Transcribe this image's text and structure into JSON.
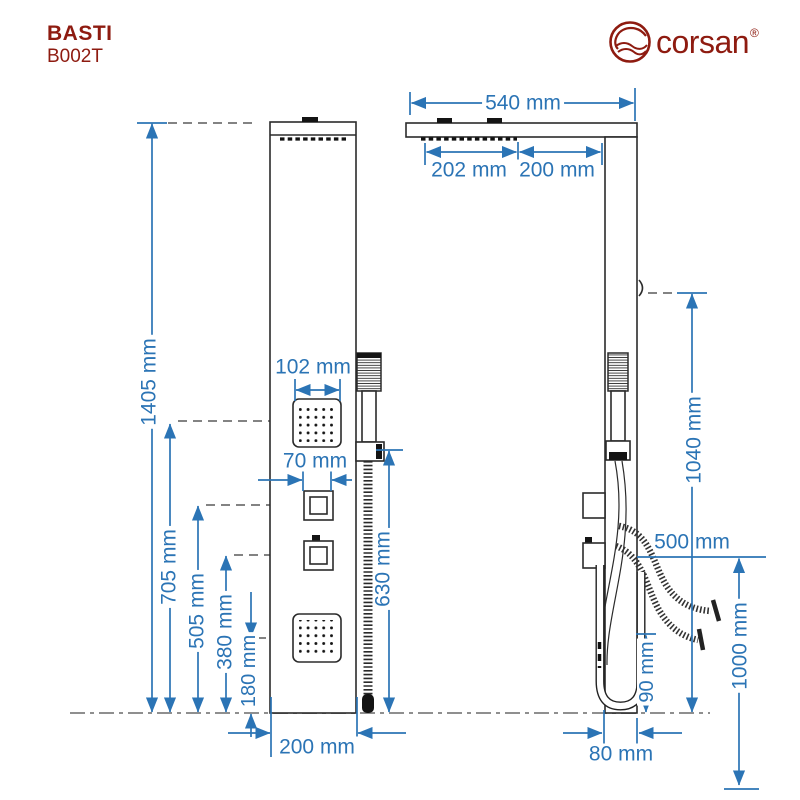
{
  "header": {
    "model": "BASTI",
    "code": "B002T"
  },
  "brand": {
    "name": "corsan",
    "registered": "®"
  },
  "colors": {
    "dimension_blue": "#2B74B5",
    "brand_red": "#8E1B10",
    "line_dark": "#2b2b2b",
    "ground_gray": "#8f8f8f"
  },
  "front_view": {
    "dims": {
      "total_height": "1405 mm",
      "top_jet_height": "705 mm",
      "upper_valve_height": "505 mm",
      "lower_valve_height": "380 mm",
      "bottom_jet_height": "180 mm",
      "jet_width": "102 mm",
      "valve_width": "70 mm",
      "hand_shower_height": "630 mm",
      "panel_width": "200 mm"
    }
  },
  "side_view": {
    "dims": {
      "head_depth": "540 mm",
      "head_nozzle_depth": "202 mm",
      "head_to_panel": "200 mm",
      "hook_height": "1040 mm",
      "spout_reach": "500 mm",
      "hose_clearance": "90 mm",
      "panel_depth": "80 mm",
      "mount_height": "1000 mm"
    }
  }
}
